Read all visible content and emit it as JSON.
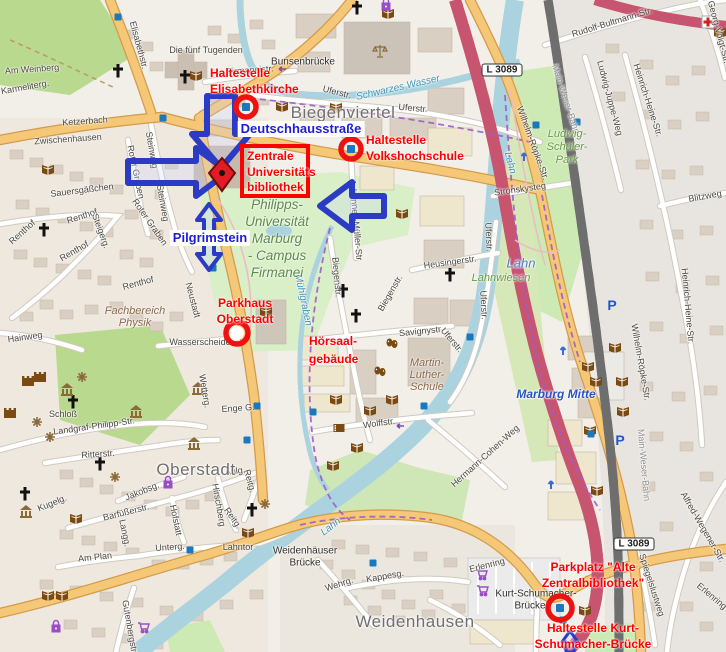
{
  "map": {
    "district_labels": [
      {
        "text": "Biegenviertel",
        "x": 343,
        "y": 113
      },
      {
        "text": "Oberstadt",
        "x": 196,
        "y": 470
      },
      {
        "text": "Weidenhausen",
        "x": 415,
        "y": 622
      }
    ],
    "street_labels": [
      {
        "text": "Elisabethstr.",
        "x": 139,
        "y": 45,
        "r": 75
      },
      {
        "text": "Am Weinberg",
        "x": 32,
        "y": 69,
        "r": -4
      },
      {
        "text": "Karmeliterg.",
        "x": 25,
        "y": 87,
        "r": -10
      },
      {
        "text": "Ketzerbach",
        "x": 85,
        "y": 121,
        "r": -4
      },
      {
        "text": "Die fünf Tugenden",
        "x": 206,
        "y": 50,
        "r": 0
      },
      {
        "text": "Bunsenbrücke",
        "x": 303,
        "y": 62,
        "r": 0,
        "cls": "name"
      },
      {
        "text": "Firmaneistr.",
        "x": 250,
        "y": 70,
        "r": -4
      },
      {
        "text": "Uferstr.",
        "x": 337,
        "y": 92,
        "r": 14
      },
      {
        "text": "Uferstr.",
        "x": 413,
        "y": 108,
        "r": 5
      },
      {
        "text": "Zwischenhausen",
        "x": 68,
        "y": 139,
        "r": -4
      },
      {
        "text": "Sauersgäßchen",
        "x": 82,
        "y": 190,
        "r": -7
      },
      {
        "text": "Steinweg",
        "x": 152,
        "y": 150,
        "r": 80
      },
      {
        "text": "Steinweg",
        "x": 163,
        "y": 203,
        "r": 80
      },
      {
        "text": "Roter Graben",
        "x": 136,
        "y": 172,
        "r": 78
      },
      {
        "text": "Roter Graben",
        "x": 150,
        "y": 222,
        "r": 55
      },
      {
        "text": "Renthof",
        "x": 82,
        "y": 216,
        "r": -18
      },
      {
        "text": "Renthof",
        "x": 22,
        "y": 232,
        "r": -42
      },
      {
        "text": "Renthof",
        "x": 74,
        "y": 251,
        "r": -30
      },
      {
        "text": "Renthof",
        "x": 138,
        "y": 283,
        "r": -15
      },
      {
        "text": "Steigerg.",
        "x": 101,
        "y": 231,
        "r": 70
      },
      {
        "text": "Neustadt",
        "x": 193,
        "y": 300,
        "r": 75
      },
      {
        "text": "Wasserscheide",
        "x": 200,
        "y": 342,
        "r": 0
      },
      {
        "text": "Wetterg.",
        "x": 205,
        "y": 391,
        "r": 80
      },
      {
        "text": "Hainweg",
        "x": 25,
        "y": 337,
        "r": -8
      },
      {
        "text": "Schloß",
        "x": 63,
        "y": 414,
        "r": 0
      },
      {
        "text": "Landgraf-Philipp-Str.",
        "x": 94,
        "y": 426,
        "r": -8
      },
      {
        "text": "Ritterstr.",
        "x": 98,
        "y": 454,
        "r": -4
      },
      {
        "text": "Jakobsg.",
        "x": 142,
        "y": 491,
        "r": -22
      },
      {
        "text": "Barfüßerstr.",
        "x": 126,
        "y": 512,
        "r": -14
      },
      {
        "text": "Langg.",
        "x": 125,
        "y": 533,
        "r": 78
      },
      {
        "text": "Kugelg.",
        "x": 52,
        "y": 503,
        "r": -22
      },
      {
        "text": "Hofstatt",
        "x": 176,
        "y": 520,
        "r": 78
      },
      {
        "text": "Hirschberg",
        "x": 219,
        "y": 505,
        "r": 80
      },
      {
        "text": "Reitg.",
        "x": 250,
        "y": 481,
        "r": 75
      },
      {
        "text": "Reitg.",
        "x": 233,
        "y": 518,
        "r": 55
      },
      {
        "text": "Aulg.",
        "x": 235,
        "y": 471,
        "r": -8
      },
      {
        "text": "Unterg.",
        "x": 170,
        "y": 547,
        "r": -4
      },
      {
        "text": "Lahntor",
        "x": 238,
        "y": 547,
        "r": 0
      },
      {
        "text": "Am Plan",
        "x": 95,
        "y": 557,
        "r": -6
      },
      {
        "text": "Gutenbergstr.",
        "x": 130,
        "y": 627,
        "r": 80
      },
      {
        "text": "Enge G.",
        "x": 238,
        "y": 408,
        "r": -4
      },
      {
        "text": "Weidenhäuser",
        "x": 305,
        "y": 551,
        "r": 0,
        "cls": "name"
      },
      {
        "text": "Brücke",
        "x": 305,
        "y": 563,
        "r": 0,
        "cls": "name"
      },
      {
        "text": "Wehrg.",
        "x": 339,
        "y": 584,
        "r": -18
      },
      {
        "text": "Kappesg.",
        "x": 385,
        "y": 576,
        "r": -10
      },
      {
        "text": "Kurt-Schumacher-",
        "x": 536,
        "y": 594,
        "r": 0,
        "cls": "name"
      },
      {
        "text": "Brücke",
        "x": 530,
        "y": 606,
        "r": 0,
        "cls": "name"
      },
      {
        "text": "Erlenring",
        "x": 487,
        "y": 565,
        "r": -14
      },
      {
        "text": "Erlenring",
        "x": 712,
        "y": 596,
        "r": 40
      },
      {
        "text": "Biegenstr.",
        "x": 337,
        "y": 277,
        "r": 85
      },
      {
        "text": "Biegenstr.",
        "x": 390,
        "y": 293,
        "r": -60
      },
      {
        "text": "Johannes-Müller-Str",
        "x": 356,
        "y": 220,
        "r": 85
      },
      {
        "text": "Savignystr.",
        "x": 421,
        "y": 331,
        "r": -6
      },
      {
        "text": "Wolffstr.",
        "x": 379,
        "y": 423,
        "r": -8
      },
      {
        "text": "Heusingerstr.",
        "x": 450,
        "y": 262,
        "r": -8
      },
      {
        "text": "Uferstr.",
        "x": 489,
        "y": 237,
        "r": 87
      },
      {
        "text": "Uferstr.",
        "x": 484,
        "y": 305,
        "r": 87
      },
      {
        "text": "Uferstr.",
        "x": 452,
        "y": 340,
        "r": 50
      },
      {
        "text": "Stronskysteg",
        "x": 520,
        "y": 189,
        "r": -8
      },
      {
        "text": "Hermann-Cohen-Weg",
        "x": 485,
        "y": 456,
        "r": -42
      },
      {
        "text": "Wilhelm-Röpke-Str.",
        "x": 533,
        "y": 143,
        "r": 70
      },
      {
        "text": "Wilhelm-Röpke-Str.",
        "x": 641,
        "y": 362,
        "r": 80
      },
      {
        "text": "Main-Weser-Bahn",
        "x": 566,
        "y": 99,
        "r": 72,
        "cls": "rail"
      },
      {
        "text": "Main-Weser-Bahn",
        "x": 644,
        "y": 465,
        "r": 85,
        "cls": "rail"
      },
      {
        "text": "Rudolf-Bultmann-Str.",
        "x": 612,
        "y": 22,
        "r": -17
      },
      {
        "text": "Ludwig-Juppe-Weg",
        "x": 610,
        "y": 98,
        "r": 75
      },
      {
        "text": "Heinrich-Heine-Str.",
        "x": 648,
        "y": 100,
        "r": 72
      },
      {
        "text": "Heinrich-Heine-Str.",
        "x": 688,
        "y": 306,
        "r": 85
      },
      {
        "text": "Blitzweg",
        "x": 705,
        "y": 196,
        "r": -10
      },
      {
        "text": "Georg-Voigt-Str.",
        "x": 719,
        "y": 32,
        "r": 75
      },
      {
        "text": "Spiegelslustweg",
        "x": 652,
        "y": 585,
        "r": 72
      },
      {
        "text": "Alfred-Wegener-Str.",
        "x": 703,
        "y": 527,
        "r": 60
      }
    ],
    "area_labels": [
      {
        "lines": [
          "Philipps-",
          "Universität",
          "Marburg",
          "- Campus",
          "Firmanei"
        ],
        "x": 277,
        "y": 196,
        "lh": 17,
        "cls": "campus"
      },
      {
        "lines": [
          "Ludwig-",
          "Schüler-",
          "Park"
        ],
        "x": 567,
        "y": 128,
        "lh": 13,
        "cls": "park"
      },
      {
        "lines": [
          "Lahnwiesen"
        ],
        "x": 501,
        "y": 272,
        "lh": 12,
        "cls": "park"
      },
      {
        "lines": [
          "Fachbereich",
          "Physik"
        ],
        "x": 135,
        "y": 305,
        "lh": 12,
        "cls": "poi"
      },
      {
        "lines": [
          "Martin-",
          "Luther-",
          "Schule"
        ],
        "x": 427,
        "y": 357,
        "lh": 12,
        "cls": "poi"
      }
    ],
    "water_labels": [
      {
        "text": "Schwarzes Wasser",
        "x": 398,
        "y": 88,
        "r": -13
      },
      {
        "text": "Lahn",
        "x": 510,
        "y": 163,
        "r": 75
      },
      {
        "text": "Lahn",
        "x": 521,
        "y": 263,
        "r": 0,
        "big": true
      },
      {
        "text": "Lahn",
        "x": 331,
        "y": 527,
        "r": -38
      },
      {
        "text": "Mühlgraben",
        "x": 303,
        "y": 300,
        "r": 78
      }
    ],
    "station_labels": [
      {
        "text": "Marburg Mitte",
        "x": 556,
        "y": 394
      }
    ],
    "route_badges": [
      {
        "text": "L 3089",
        "x": 502,
        "y": 70
      },
      {
        "text": "L 3089",
        "x": 634,
        "y": 544
      }
    ],
    "icons": {
      "book": [
        [
          48,
          169
        ],
        [
          196,
          75
        ],
        [
          282,
          106
        ],
        [
          336,
          107
        ],
        [
          388,
          13
        ],
        [
          402,
          213
        ],
        [
          266,
          311
        ],
        [
          336,
          399
        ],
        [
          370,
          410
        ],
        [
          392,
          399
        ],
        [
          333,
          465
        ],
        [
          357,
          447
        ],
        [
          248,
          532
        ],
        [
          76,
          518
        ],
        [
          48,
          595
        ],
        [
          62,
          595
        ],
        [
          615,
          347
        ],
        [
          588,
          366
        ],
        [
          596,
          381
        ],
        [
          622,
          381
        ],
        [
          623,
          411
        ],
        [
          590,
          430
        ],
        [
          597,
          490
        ],
        [
          585,
          610
        ],
        [
          720,
          32
        ]
      ],
      "church": [
        [
          118,
          71
        ],
        [
          185,
          77
        ],
        [
          44,
          230
        ],
        [
          73,
          402
        ],
        [
          100,
          464
        ],
        [
          252,
          510
        ],
        [
          25,
          494
        ],
        [
          343,
          291
        ],
        [
          356,
          316
        ],
        [
          450,
          275
        ],
        [
          357,
          8
        ]
      ],
      "museum": [
        [
          67,
          390
        ],
        [
          198,
          389
        ],
        [
          136,
          412
        ],
        [
          194,
          444
        ],
        [
          26,
          512
        ]
      ],
      "castle": [
        [
          28,
          381
        ],
        [
          10,
          413
        ],
        [
          40,
          377
        ]
      ],
      "viewpoint": [
        [
          82,
          377
        ],
        [
          37,
          422
        ],
        [
          50,
          437
        ],
        [
          115,
          477
        ],
        [
          265,
          504
        ]
      ],
      "theatre": [
        [
          392,
          343
        ],
        [
          380,
          371
        ]
      ],
      "cinema": [
        [
          339,
          428
        ]
      ],
      "courthouse": [
        [
          380,
          51
        ]
      ],
      "hospital": [
        [
          708,
          22
        ]
      ],
      "parking": [
        [
          612,
          305
        ],
        [
          620,
          440
        ]
      ],
      "supermarket": [
        [
          481,
          574
        ],
        [
          482,
          590
        ],
        [
          143,
          627
        ]
      ],
      "shop": [
        [
          56,
          627
        ],
        [
          168,
          483
        ],
        [
          386,
          5
        ]
      ],
      "bus": [
        [
          118,
          17
        ],
        [
          163,
          118
        ],
        [
          213,
          268
        ],
        [
          257,
          406
        ],
        [
          470,
          337
        ],
        [
          577,
          122
        ],
        [
          591,
          434
        ],
        [
          247,
          440
        ],
        [
          190,
          550
        ],
        [
          373,
          563
        ],
        [
          424,
          406
        ],
        [
          313,
          412
        ],
        [
          563,
          620
        ],
        [
          536,
          125
        ]
      ],
      "oneway": [
        [
          282,
          69
        ],
        [
          400,
          426
        ]
      ],
      "road_arrow": [
        [
          524,
          156
        ],
        [
          563,
          350
        ],
        [
          551,
          484
        ]
      ]
    }
  },
  "annotations": {
    "colors": {
      "red": "#ff0000",
      "blue": "#1d1dd6",
      "arrow": "#2b3bc4"
    },
    "red_labels": [
      {
        "id": "stop-elisabethkirche",
        "lines": [
          "Haltestelle",
          "Elisabethkirche"
        ],
        "x": 210,
        "y": 66,
        "align": "left"
      },
      {
        "id": "library-target",
        "lines": [
          "Zentrale",
          "Universitäts",
          "bibliothek"
        ],
        "x": 247,
        "y": 149,
        "align": "left"
      },
      {
        "id": "stop-volkshochschule",
        "lines": [
          "Haltestelle",
          "Volkshochschule"
        ],
        "x": 366,
        "y": 133,
        "align": "left"
      },
      {
        "id": "parkhaus-oberstadt",
        "lines": [
          "Parkhaus",
          "Oberstadt"
        ],
        "x": 245,
        "y": 296,
        "align": "center"
      },
      {
        "id": "hoersaalgebaeude",
        "lines": [
          "Hörsaal-",
          "gebäude"
        ],
        "x": 309,
        "y": 332,
        "align": "left",
        "lh": 18
      },
      {
        "id": "parkplatz-alte-zb",
        "lines": [
          "Parkplatz \"Alte",
          "Zentralbibliothek\""
        ],
        "x": 593,
        "y": 560,
        "align": "center"
      },
      {
        "id": "stop-kurt-schumacher",
        "lines": [
          "Haltestelle Kurt-",
          "Schumacher-Brücke"
        ],
        "x": 593,
        "y": 621,
        "align": "center"
      }
    ],
    "blue_labels": [
      {
        "id": "deutschhausstrasse",
        "text": "Deutschhausstraße",
        "x": 301,
        "y": 129
      },
      {
        "id": "pilgrimstein",
        "text": "Pilgrimstein",
        "x": 210,
        "y": 238
      }
    ],
    "markers": {
      "rings": [
        {
          "x": 246,
          "y": 107,
          "r": 10,
          "bus": true
        },
        {
          "x": 351,
          "y": 149,
          "r": 10,
          "bus": true
        },
        {
          "x": 237,
          "y": 333,
          "r": 11,
          "bus": false
        },
        {
          "x": 560,
          "y": 608,
          "r": 12,
          "bus": true
        }
      ],
      "pin": {
        "x": 222,
        "y": 173
      },
      "box": {
        "x": 242,
        "y": 146,
        "w": 66,
        "h": 50
      }
    }
  }
}
